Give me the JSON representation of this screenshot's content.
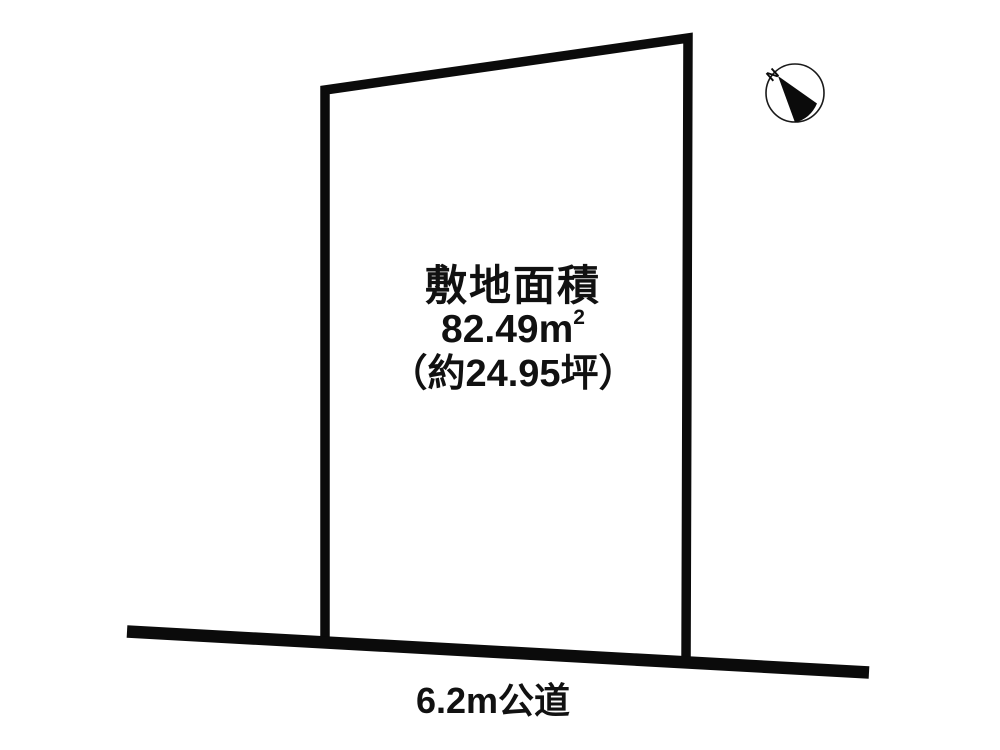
{
  "page": {
    "background": "#ffffff"
  },
  "plot": {
    "area_title": "敷地面積",
    "area_value": "82.49",
    "area_unit": "m",
    "area_unit_exponent": "2",
    "area_tsubo": "（約24.95坪）"
  },
  "road": {
    "label": "6.2m公道"
  },
  "compass": {
    "north_label": "N"
  },
  "colors": {
    "line": "#0b0b0b",
    "text": "#111111"
  }
}
